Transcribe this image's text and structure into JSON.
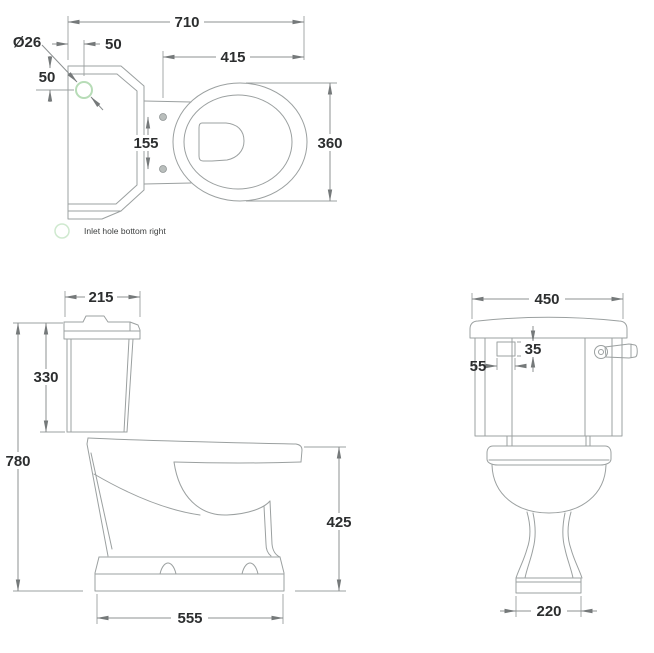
{
  "colors": {
    "background": "#ffffff",
    "drawing_line": "#9ba0a0",
    "dimension_line": "#8d9192",
    "dimension_text": "#2c2e2f",
    "inlet_green": "#b7dcb7",
    "legend_green": "#cfe9cf",
    "hinge_hole_fill": "#b9bebc"
  },
  "plan_view": {
    "dimensions": {
      "overall_length": "710",
      "seat_length": "415",
      "bowl_width": "360",
      "hinge_centres": "155",
      "inlet_offset_horizontal": "50",
      "inlet_offset_vertical": "50",
      "inlet_diameter": "Ø26"
    }
  },
  "side_view": {
    "dimensions": {
      "cistern_depth": "215",
      "cistern_height": "330",
      "overall_height": "780",
      "rim_height": "425",
      "overall_depth": "555"
    }
  },
  "front_view": {
    "dimensions": {
      "cistern_width": "450",
      "cutout_height": "35",
      "cutout_width": "55",
      "base_width": "220"
    }
  },
  "legend": {
    "label": "Inlet hole bottom right"
  }
}
